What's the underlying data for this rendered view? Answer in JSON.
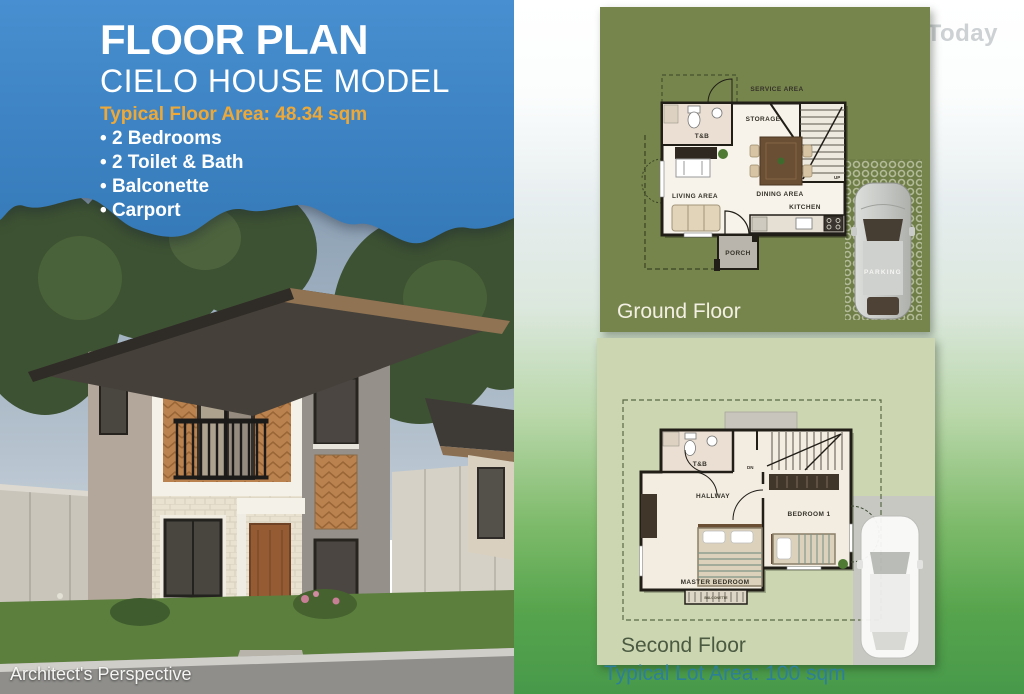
{
  "title_block": {
    "title": "FLOOR PLAN",
    "subtitle": "CIELO HOUSE MODEL",
    "floor_area": "Typical Floor Area: 48.34 sqm",
    "features": [
      "2 Bedrooms",
      "2 Toilet & Bath",
      "Balconette",
      "Carport"
    ]
  },
  "perspective_caption": "Architect's Perspective",
  "hashtag": "#LetsBeginToday",
  "ground_floor": {
    "caption": "Ground Floor",
    "labels": {
      "service_area": "SERVICE AREA",
      "storage": "STORAGE",
      "toilet_bath": "T&B",
      "living_area": "LIVING AREA",
      "dining_area": "DINING AREA",
      "kitchen": "KITCHEN",
      "porch": "PORCH",
      "parking": "PARKING",
      "up": "UP"
    }
  },
  "second_floor": {
    "caption": "Second Floor",
    "labels": {
      "toilet_bath": "T&B",
      "down": "DN",
      "hallway": "HALLWAY",
      "bedroom1": "BEDROOM 1",
      "master_bedroom": "MASTER BEDROOM",
      "balconette": "BALCONETTE"
    }
  },
  "lot_area": "Typical Lot Area: 100 sqm",
  "colors": {
    "panel_blue": "#3c85c6",
    "accent_orange": "#eda837",
    "olive_panel": "#76854c",
    "sage_panel": "#ccd7b2",
    "teal_text": "#2d7f99",
    "bottom_green": "#47994a"
  }
}
